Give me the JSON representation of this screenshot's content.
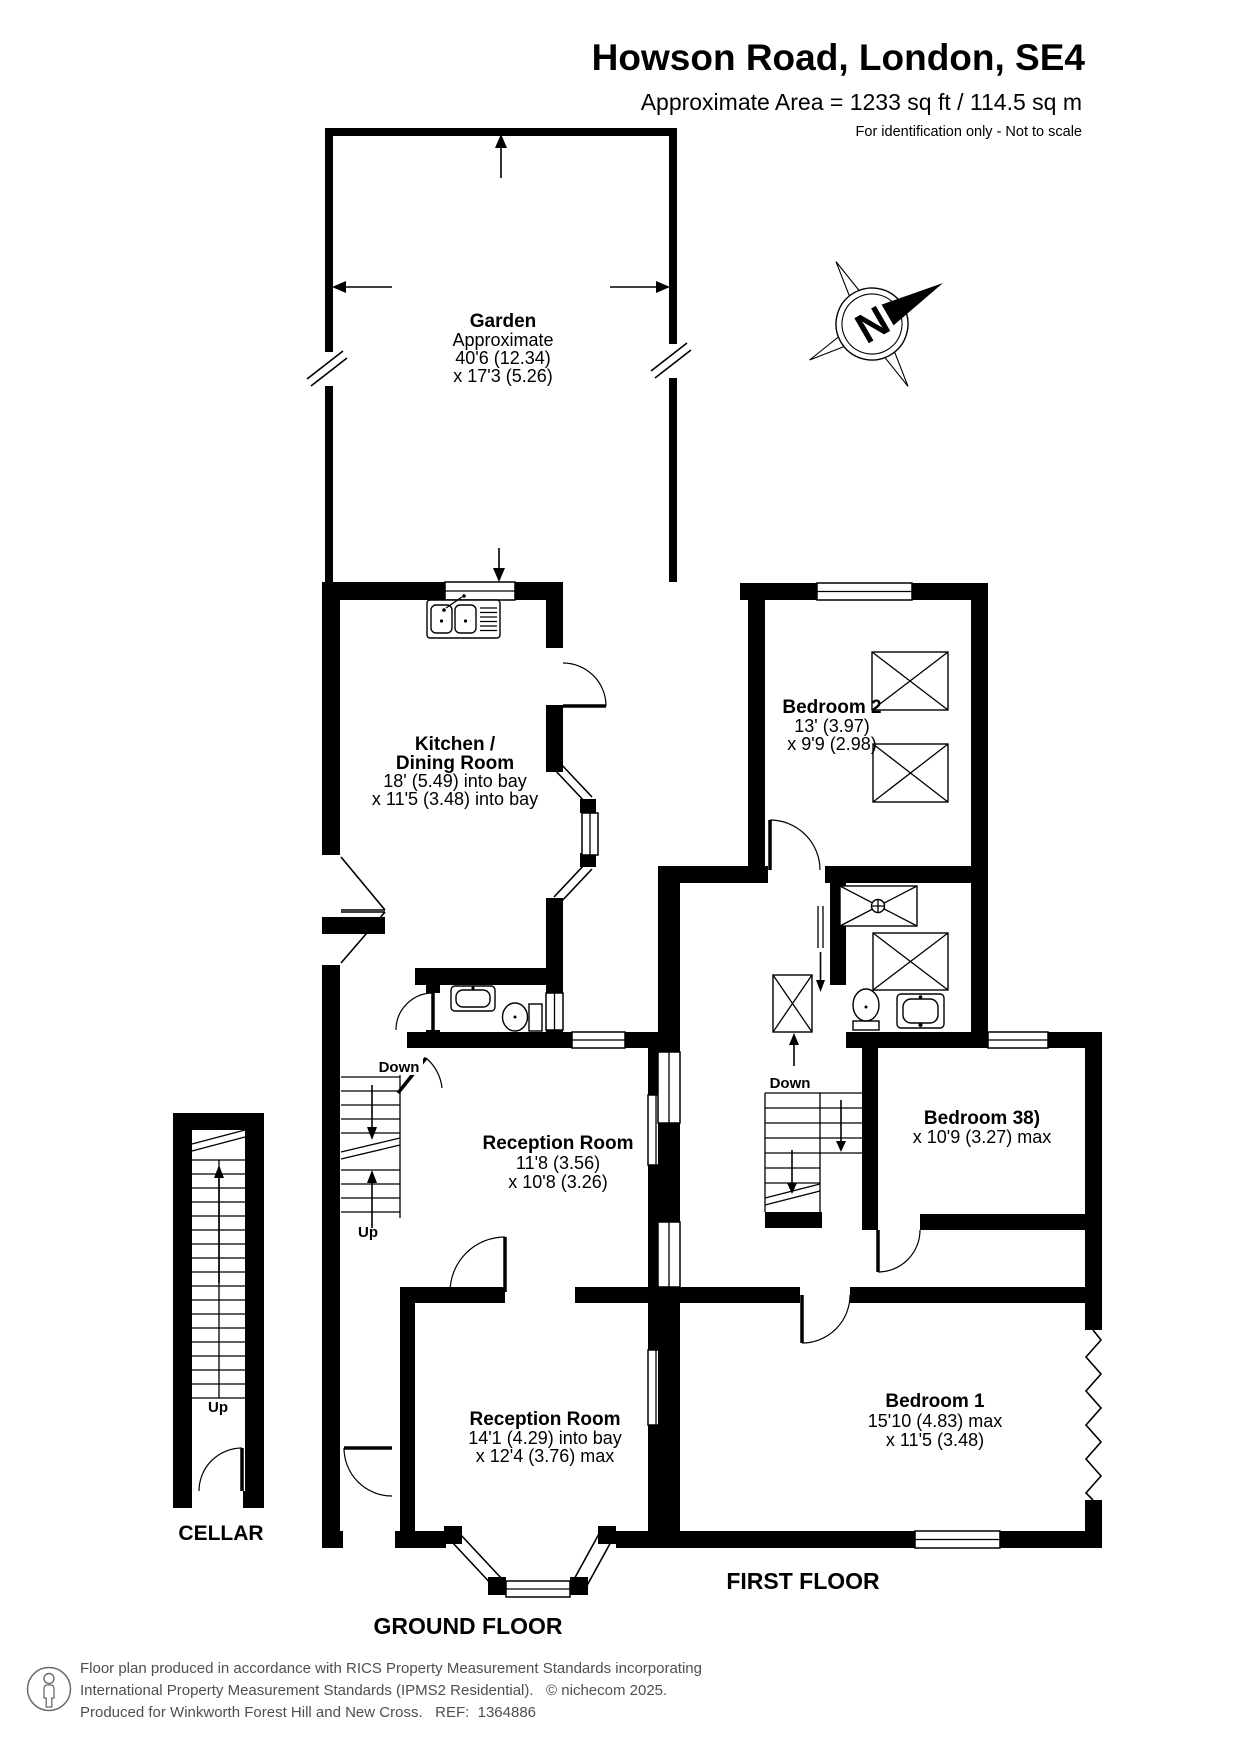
{
  "header": {
    "title": "Howson Road, London, SE4",
    "area": "Approximate Area = 1233 sq ft / 114.5 sq m",
    "disclaimer": "For identification only - Not to scale"
  },
  "compass": {
    "letter": "N"
  },
  "garden": {
    "name": "Garden",
    "approx": "Approximate",
    "dim1": "40'6 (12.34)",
    "dim2": "x 17'3 (5.26)"
  },
  "ground_floor": {
    "label": "GROUND FLOOR",
    "kitchen": {
      "name1": "Kitchen /",
      "name2": "Dining Room",
      "dim1": "18' (5.49) into bay",
      "dim2": "x 11'5 (3.48) into bay"
    },
    "reception_rear": {
      "name": "Reception Room",
      "dim1": "11'8 (3.56)",
      "dim2": "x 10'8 (3.26)"
    },
    "reception_front": {
      "name": "Reception Room",
      "dim1": "14'1 (4.29) into bay",
      "dim2": "x 12'4 (3.76) max"
    },
    "stairs": {
      "down": "Down",
      "up": "Up"
    }
  },
  "first_floor": {
    "label": "FIRST FLOOR",
    "bedroom2": {
      "name": "Bedroom 2",
      "dim1": "13' (3.97)",
      "dim2": "x 9'9 (2.98)"
    },
    "bedroom3": {
      "name": "Bedroom 38)",
      "dim1": "x 10'9 (3.27) max"
    },
    "bedroom1": {
      "name": "Bedroom 1",
      "dim1": "15'10 (4.83) max",
      "dim2": "x 11'5 (3.48)"
    },
    "stairs": {
      "down": "Down"
    }
  },
  "cellar": {
    "label": "CELLAR",
    "stairs": {
      "up": "Up"
    }
  },
  "footer": {
    "line1": "Floor plan produced in accordance with RICS Property Measurement Standards incorporating",
    "line2": "International Property Measurement Standards (IPMS2 Residential).   © nichecom 2025.",
    "line3": "Produced for Winkworth Forest Hill and New Cross.   REF:  1364886"
  },
  "colors": {
    "line": "#000000",
    "footer_text": "#4f4f4f",
    "background": "#ffffff"
  }
}
